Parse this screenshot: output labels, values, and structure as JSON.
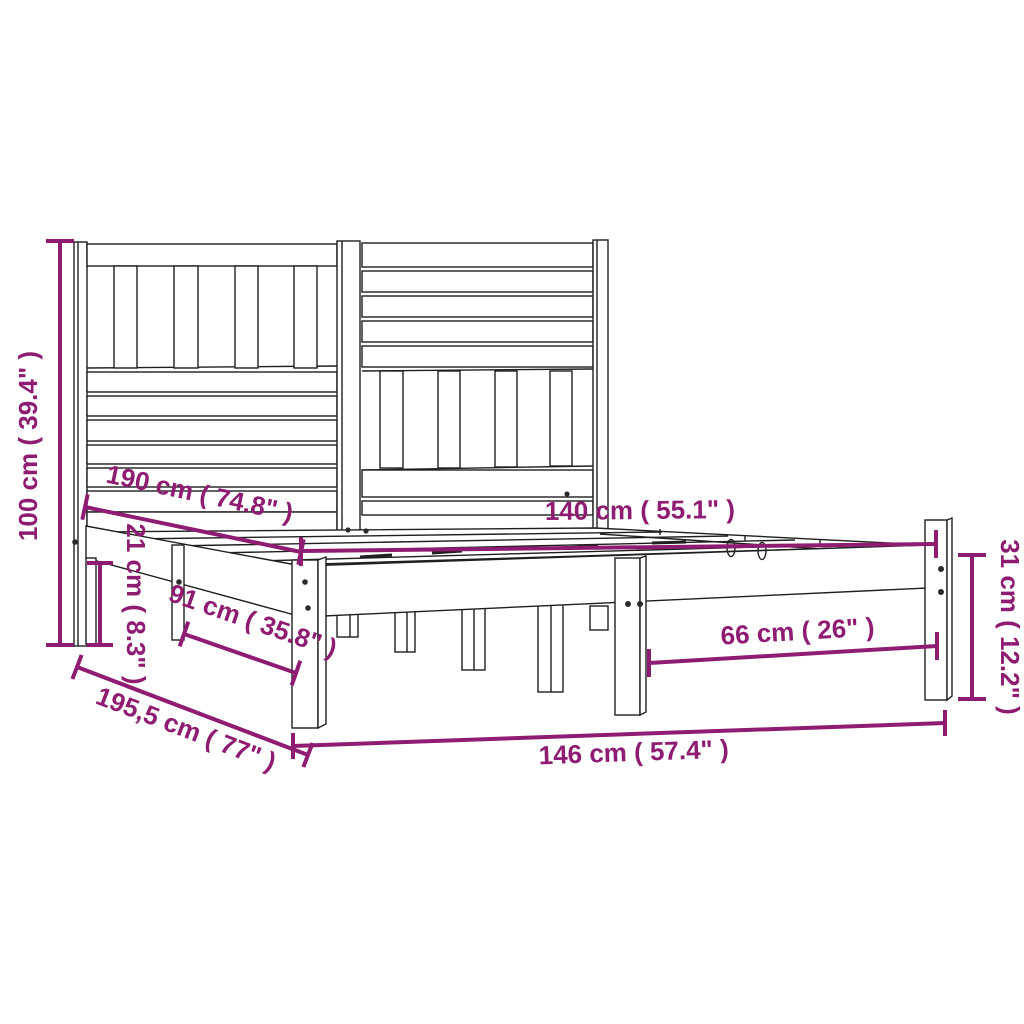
{
  "figure": {
    "kind": "product-dimension-diagram",
    "subject": "wooden bed frame with slatted headboard",
    "background": "#FFFFFF"
  },
  "colors": {
    "dimension_annotation": "#8E1C72",
    "line_drawing": "#1F1F1F"
  },
  "dimensions": [
    {
      "id": "headboard-height",
      "label": "100 cm ( 39.4\" )"
    },
    {
      "id": "head-rail-height",
      "label": "21 cm ( 8.3\" )"
    },
    {
      "id": "inner-length",
      "label": "190 cm ( 74.8\" )"
    },
    {
      "id": "inner-width",
      "label": "140 cm ( 55.1\" )"
    },
    {
      "id": "side-leg-spacing",
      "label": "91 cm ( 35.8\" )"
    },
    {
      "id": "front-leg-spacing",
      "label": "66 cm ( 26\" )"
    },
    {
      "id": "foot-end-height",
      "label": "31 cm ( 12.2\" )"
    },
    {
      "id": "total-length",
      "label": "195,5 cm ( 77\" )"
    },
    {
      "id": "total-width",
      "label": "146 cm ( 57.4\" )"
    }
  ]
}
